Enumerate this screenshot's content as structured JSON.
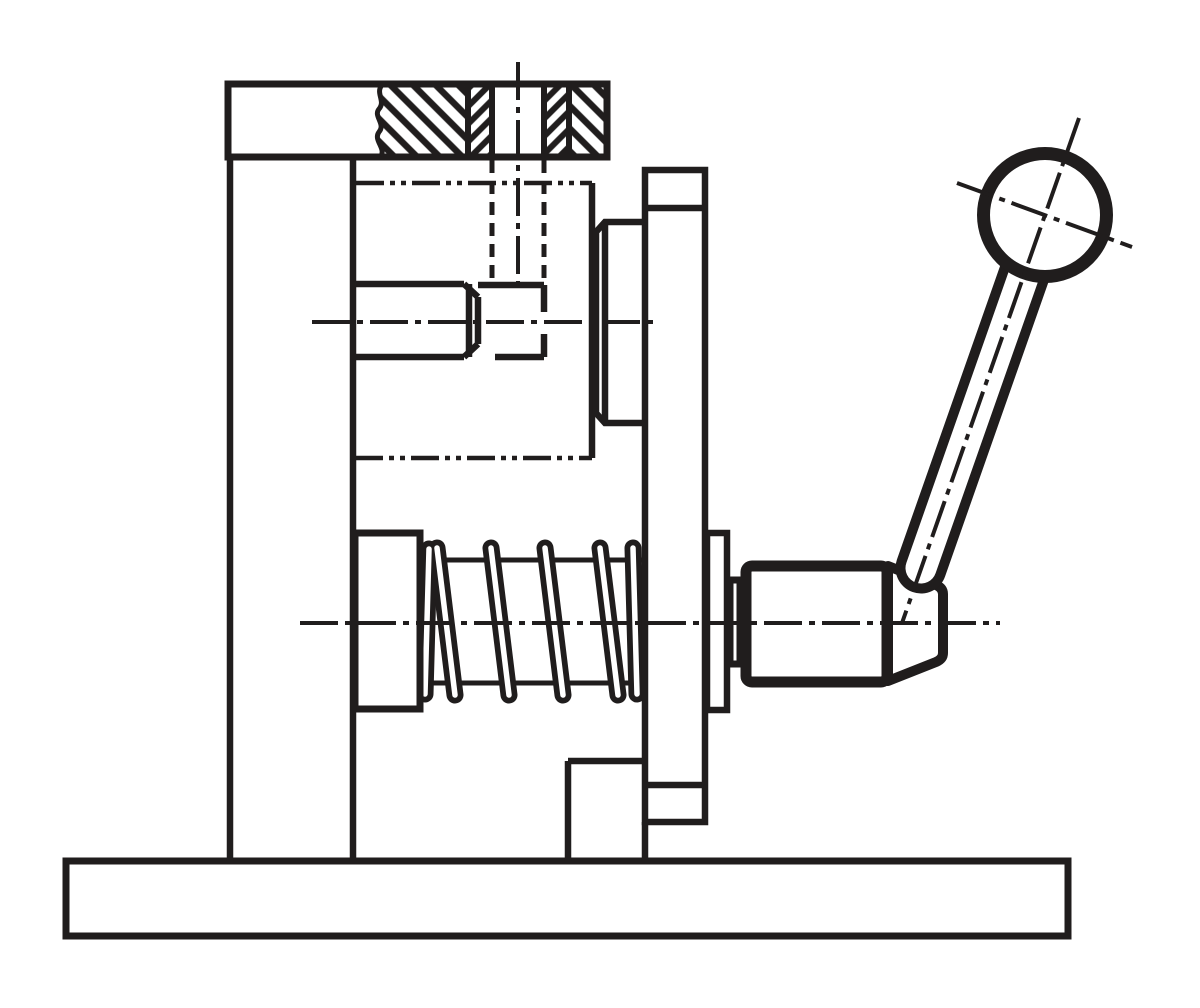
{
  "drawing": {
    "type": "technical-line-drawing",
    "description": "Sectioned side view of a spring-loaded indexing plunger with ball-handle clamping lever, mounted on an angle bracket with base plate",
    "background_color": "#ffffff",
    "ink_color": "#201d1d",
    "visible_text": "none",
    "line_styles": {
      "outline_weight": 6.5,
      "plunger_outline_weight": 11,
      "ball_outline_weight": 13,
      "centerline_weight": 4,
      "centerline_pattern": "long-dash dot",
      "hidden_line_pattern": "dashed",
      "phantom_line_pattern": "long-dash dot dot"
    },
    "parts": [
      {
        "name": "base-plate"
      },
      {
        "name": "support-column"
      },
      {
        "name": "top-plate-sectioned"
      },
      {
        "name": "threaded-bushing-section"
      },
      {
        "name": "stop-pin"
      },
      {
        "name": "guide-boss"
      },
      {
        "name": "compression-spring"
      },
      {
        "name": "spring-seat"
      },
      {
        "name": "flange-plate"
      },
      {
        "name": "flange-boss"
      },
      {
        "name": "clamping-collar"
      },
      {
        "name": "plunger-body"
      },
      {
        "name": "plunger-nose"
      },
      {
        "name": "lever-arm"
      },
      {
        "name": "ball-knob"
      }
    ]
  }
}
